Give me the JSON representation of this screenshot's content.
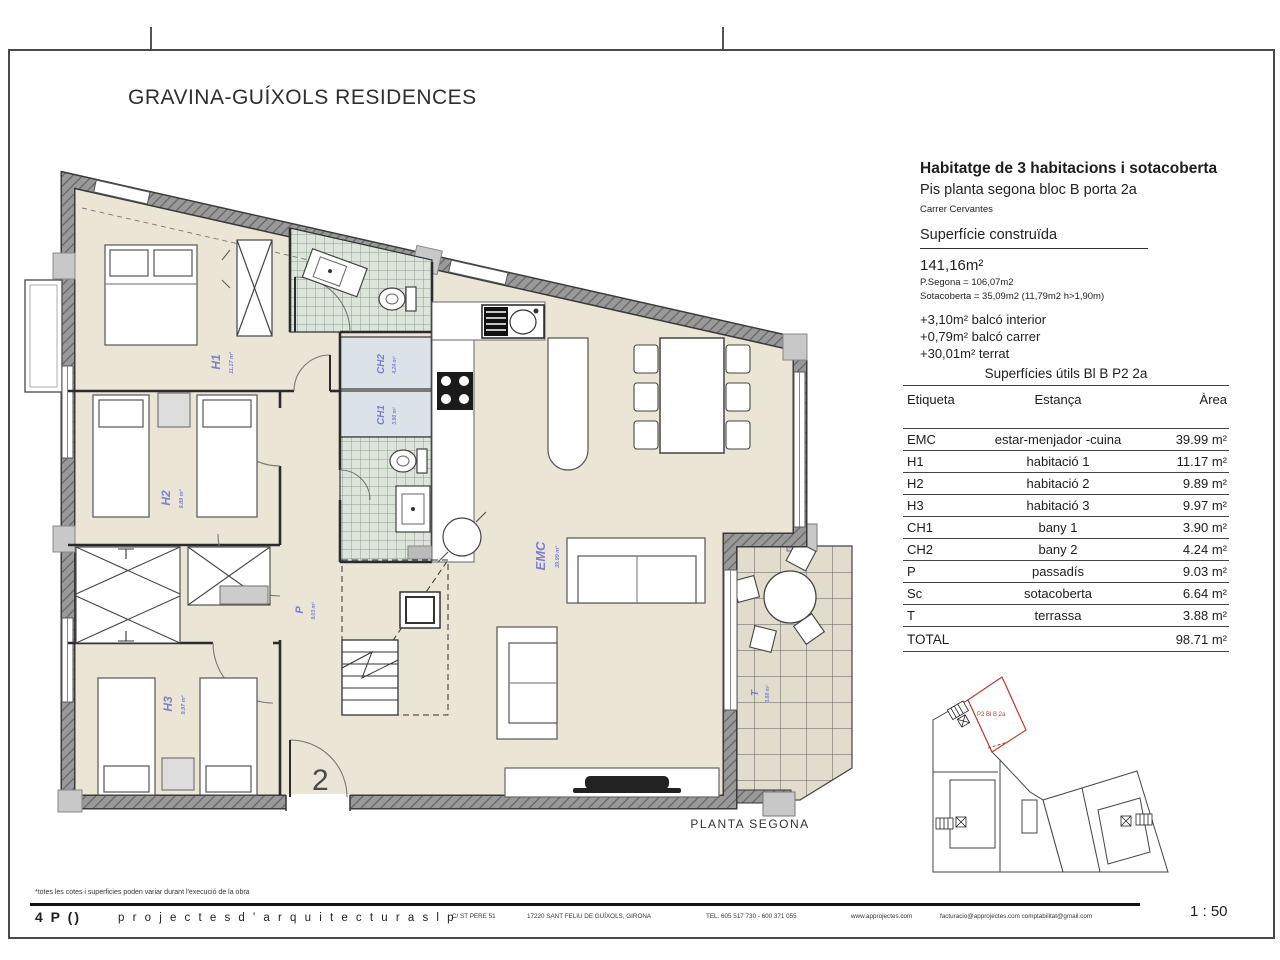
{
  "page": {
    "title": "GRAVINA-GUÍXOLS RESIDENCES",
    "scale": "1 : 50"
  },
  "info_panel": {
    "heading": "Habitatge de 3 habitacions i sotacoberta",
    "subheading": "Pis planta segona bloc B porta 2a",
    "address": "Carrer Cervantes",
    "built_title": "Superfície construïda",
    "built_total": "141,16m²",
    "built_line1": "P.Segona = 106,07m2",
    "built_line2": "Sotacoberta = 35,09m2 (11,79m2 h>1,90m)",
    "extra1": "+3,10m² balcó interior",
    "extra2": "+0,79m² balcó carrer",
    "extra3": "+30,01m² terrat"
  },
  "areas_table": {
    "title": "Superfícies útils Bl B P2 2a",
    "col_etiqueta": "Etiqueta",
    "col_estanca": "Estança",
    "col_area": "Àrea",
    "rows": [
      {
        "tag": "EMC",
        "room": "estar-menjador -cuina",
        "area": "39.99 m²"
      },
      {
        "tag": "H1",
        "room": "habitació 1",
        "area": "11.17 m²"
      },
      {
        "tag": "H2",
        "room": "habitació 2",
        "area": "9.89 m²"
      },
      {
        "tag": "H3",
        "room": "habitació 3",
        "area": "9.97 m²"
      },
      {
        "tag": "CH1",
        "room": "bany 1",
        "area": "3.90 m²"
      },
      {
        "tag": "CH2",
        "room": "bany 2",
        "area": "4.24 m²"
      },
      {
        "tag": "P",
        "room": "passadís",
        "area": "9.03 m²"
      },
      {
        "tag": "Sc",
        "room": "sotacoberta",
        "area": "6.64 m²"
      },
      {
        "tag": "T",
        "room": "terrassa",
        "area": "3.88 m²"
      }
    ],
    "total_label": "TOTAL",
    "total_area": "98.71 m²"
  },
  "plan": {
    "caption": "PLANTA SEGONA",
    "entrance_number": "2",
    "labels": {
      "h1": {
        "name": "H1",
        "area": "11.17 m²"
      },
      "h2": {
        "name": "H2",
        "area": "9.89 m²"
      },
      "h3": {
        "name": "H3",
        "area": "9.97 m²"
      },
      "ch1": {
        "name": "CH1",
        "area": "3.90 m²"
      },
      "ch2": {
        "name": "CH2",
        "area": "4.24 m²"
      },
      "emc": {
        "name": "EMC",
        "area": "39.99 m²"
      },
      "p": {
        "name": "P",
        "area": "9.03 m²"
      },
      "t": {
        "name": "T",
        "area": "3.88 m²"
      }
    }
  },
  "site_plan": {
    "unit_label": "P2 Bl B 2a"
  },
  "footer": {
    "note": "*totes les cotes i superficies poden variar durant l'execució de la obra",
    "logo": "4 P ()",
    "firm": "p r o j e c t e s   d ' a r q u i t e c t u r a   s l p",
    "address1": "C/ ST PERE 51",
    "address2": "17220 SANT FELIU DE GUÍXOLS, GIRONA",
    "phone": "TEL. 605 517 730 - 600 371 055",
    "web": "www.approjectes.com",
    "emails": "facturacio@approjectes.com   comptabilitat@gmail.com"
  }
}
